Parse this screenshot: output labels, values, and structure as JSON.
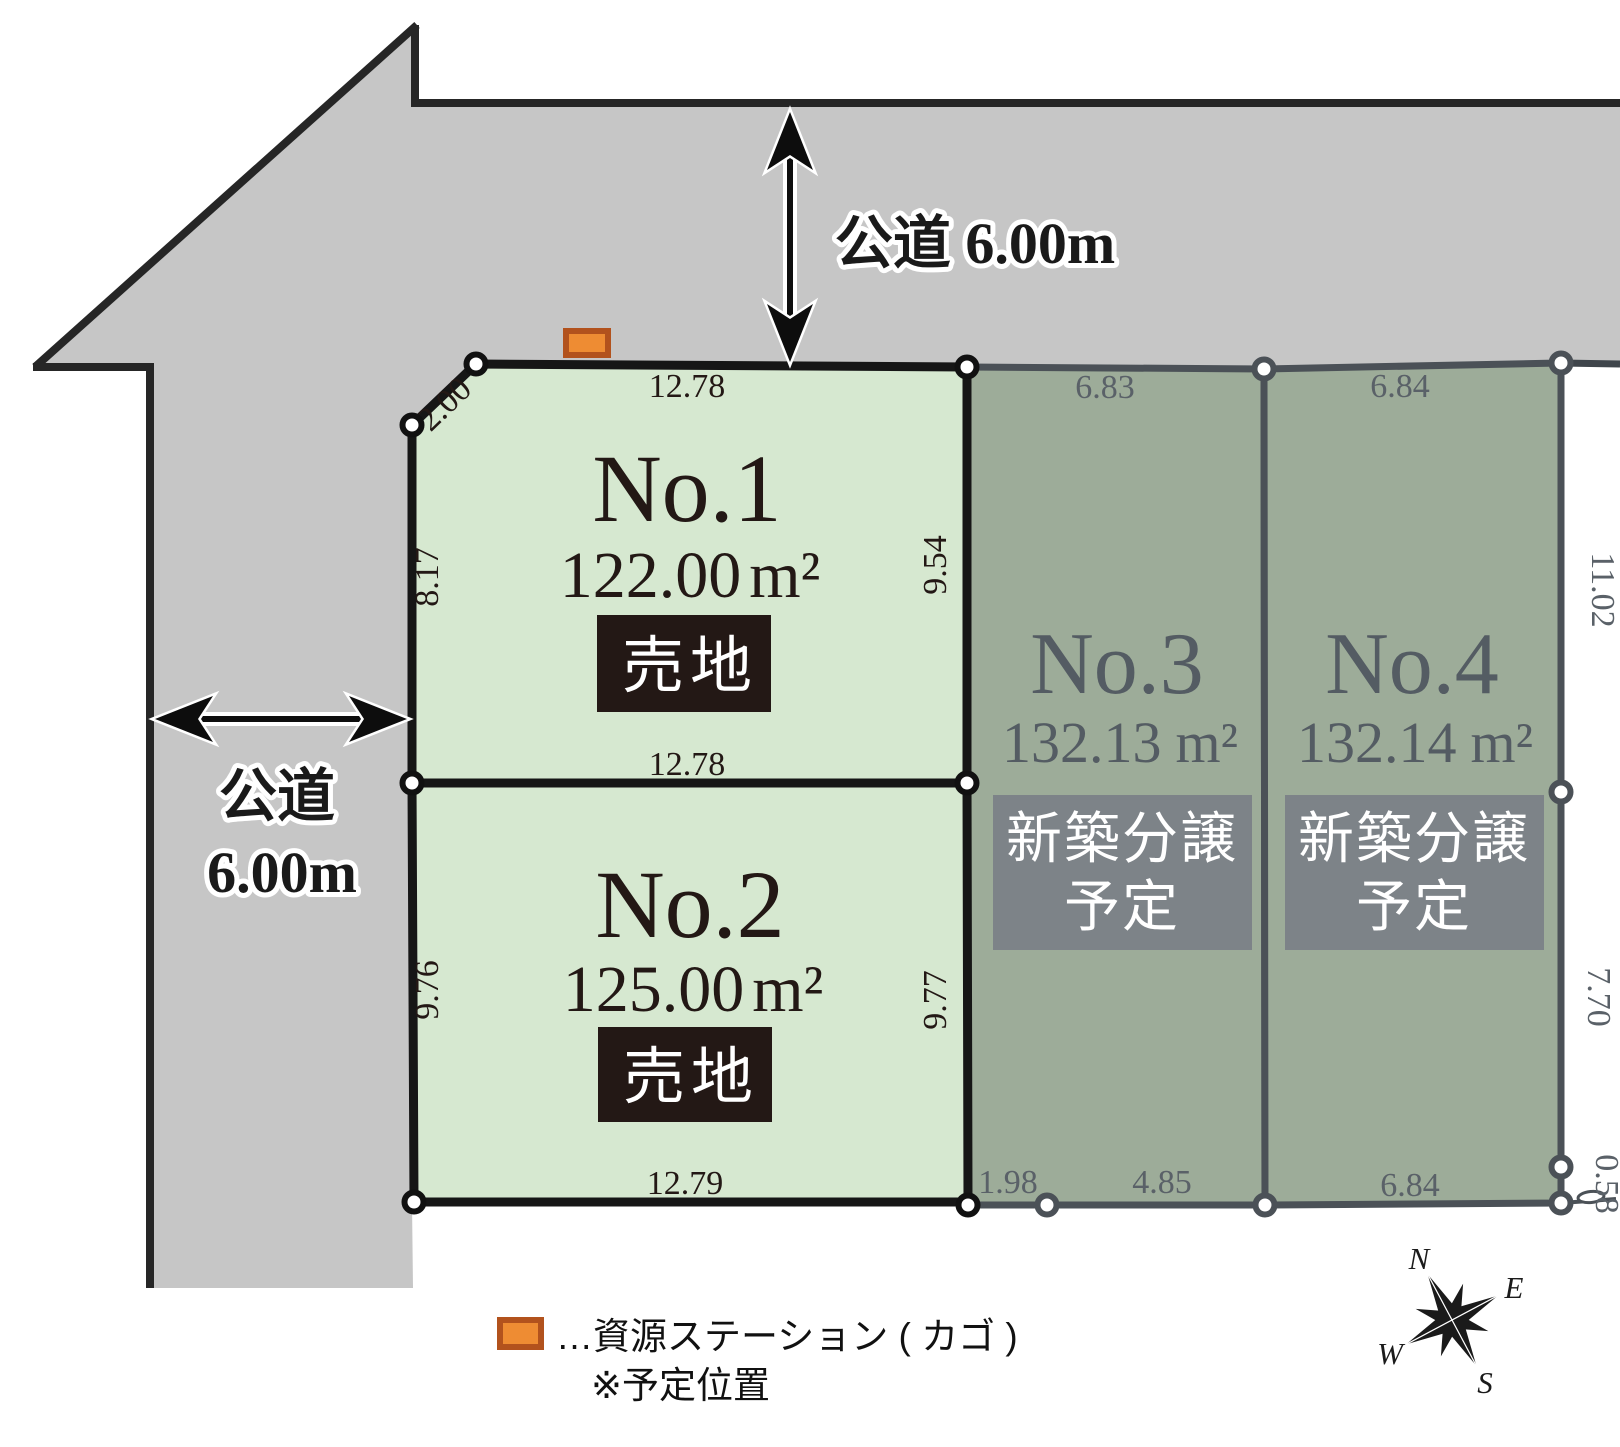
{
  "roads": {
    "top": {
      "label": "公道 6.00m"
    },
    "left": {
      "line1": "公道",
      "line2": "6.00m"
    }
  },
  "lots": {
    "no1": {
      "name": "No.1",
      "area": "122.00",
      "unit": "m²",
      "status": "売地",
      "dim_top": "12.78",
      "dim_chamfer": "2.00",
      "dim_left": "8.17",
      "dim_right": "9.54",
      "dim_bottom": "12.78"
    },
    "no2": {
      "name": "No.2",
      "area": "125.00",
      "unit": "m²",
      "status": "売地",
      "dim_left": "9.76",
      "dim_right": "9.77",
      "dim_bottom": "12.79"
    },
    "no3": {
      "name": "No.3",
      "area": "132.13",
      "unit": "m²",
      "status_line1": "新築分譲",
      "status_line2": "予定",
      "dim_top": "6.83",
      "dim_bottom_left": "1.98",
      "dim_bottom_right": "4.85"
    },
    "no4": {
      "name": "No.4",
      "area": "132.14",
      "unit": "m²",
      "status_line1": "新築分譲",
      "status_line2": "予定",
      "dim_top": "6.84",
      "dim_bottom": "6.84",
      "dim_right_upper": "11.02",
      "dim_right_lower": "7.70",
      "dim_right_corner": "0.58"
    }
  },
  "legend": {
    "line1": "…資源ステーション ( カゴ )",
    "line2": "※予定位置"
  },
  "compass": {
    "north": "N",
    "east": "E",
    "south": "S",
    "west": "W"
  },
  "colors": {
    "road": "#c6c6c6",
    "road_border": "#262626",
    "lot_for_sale_fill": "#d6e8d0",
    "lot_for_sale_border": "#161616",
    "lot_planned_fill": "#9dac99",
    "lot_planned_border": "#4b5157",
    "sale_badge": "#231815",
    "planned_badge": "#7d8388",
    "marker_fill": "#ee8c33",
    "marker_border": "#b2521d",
    "ink_dark": "#231815",
    "ink_gray": "#545c63"
  }
}
